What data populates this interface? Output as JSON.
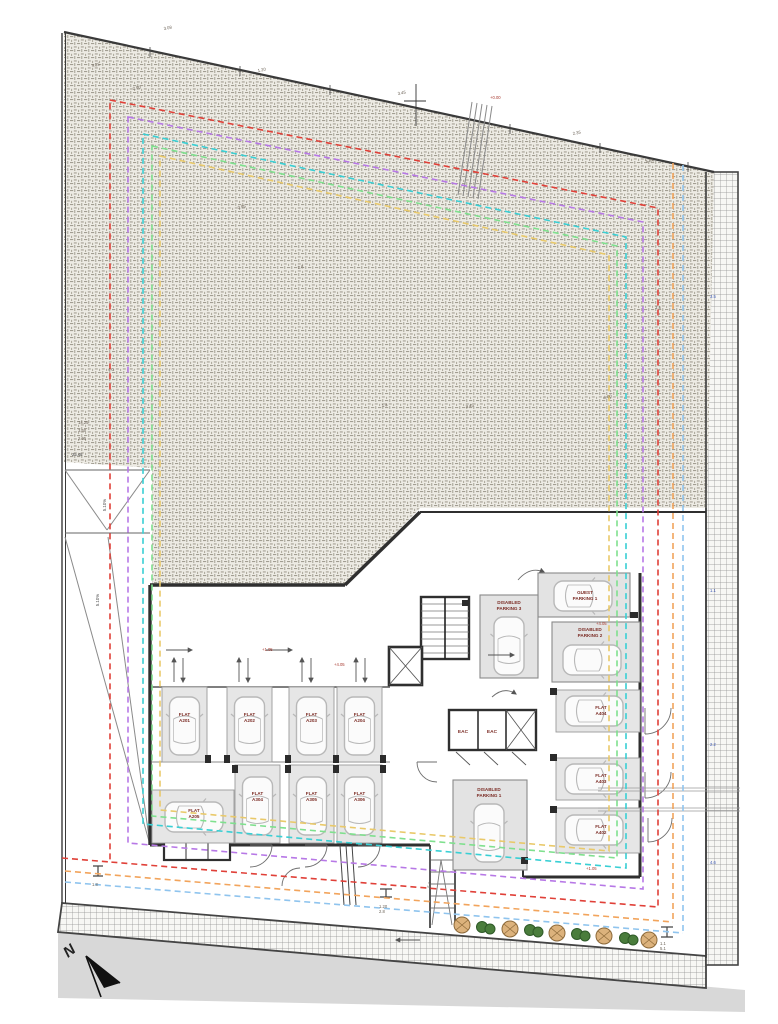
{
  "drawing": {
    "type": "architectural-site-plan",
    "north_label": "N"
  },
  "stalls": [
    {
      "line1": "FLAT",
      "line2": "A201"
    },
    {
      "line1": "FLAT",
      "line2": "A202"
    },
    {
      "line1": "FLAT",
      "line2": "A203"
    },
    {
      "line1": "FLAT",
      "line2": "A204"
    },
    {
      "line1": "FLAT",
      "line2": "A304"
    },
    {
      "line1": "FLAT",
      "line2": "A305"
    },
    {
      "line1": "FLAT",
      "line2": "A306"
    },
    {
      "line1": "FLAT",
      "line2": "A205"
    },
    {
      "line1": "FLAT",
      "line2": "A404"
    },
    {
      "line1": "FLAT",
      "line2": "A403"
    },
    {
      "line1": "FLAT",
      "line2": "A402"
    },
    {
      "line1": "GUEST",
      "line2": "PARKING 1"
    },
    {
      "line1": "DISABLED",
      "line2": "PARKING 2"
    },
    {
      "line1": "DISABLED",
      "line2": "PARKING 3"
    },
    {
      "line1": "DISABLED",
      "line2": "PARKING 1"
    }
  ],
  "rooms": {
    "eac_a": "EAC",
    "eac_b": "EAC"
  },
  "ramp": {
    "slope_a": "5.10%",
    "slope_b": "5.10%"
  },
  "dims": [
    "3.08",
    "4.25",
    "2.90",
    "1.20",
    "3.45",
    "2.35",
    "+4.05",
    "+1.05",
    "5.64",
    "3.95",
    "2.8",
    "4.0",
    "1.8",
    "6.00",
    "25.48",
    "14.25",
    "3.60",
    "2.95",
    "3.5",
    "1.1",
    "2.2",
    "4.6",
    "+0.00",
    "5.1"
  ],
  "outline_colors": {
    "red": "#e04038",
    "purple": "#b778e6",
    "cyan": "#39cfd4",
    "green": "#7fe08e",
    "tan": "#e9c96a",
    "orange": "#f2a45c",
    "lightblue": "#8fc4ee"
  }
}
